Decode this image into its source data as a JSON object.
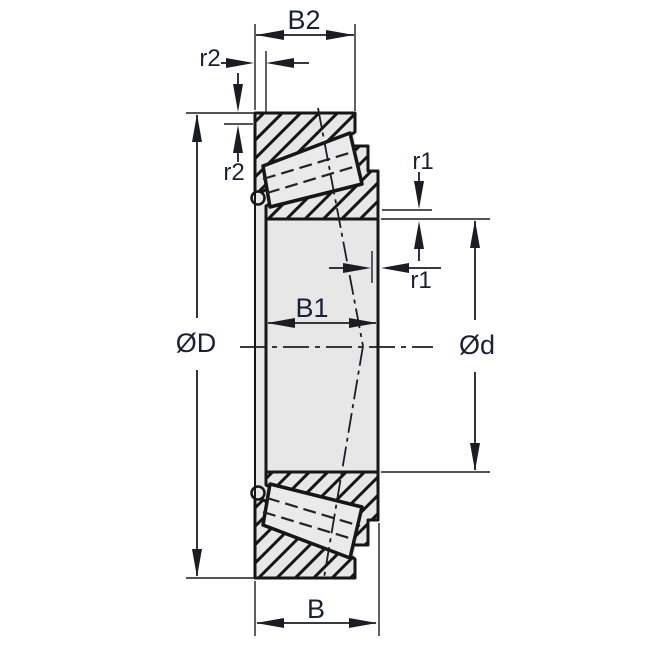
{
  "diagram": {
    "kind": "engineering-drawing",
    "subject": "tapered-roller-bearing-cross-section",
    "labels": {
      "b2": "B2",
      "b1": "B1",
      "b": "B",
      "outer_diameter": "ØD",
      "bore_diameter": "Ød",
      "r1": "r1",
      "r2": "r2"
    },
    "colors": {
      "line": "#161616",
      "dimension_line": "#1c1c24",
      "label_text": "#1b2134",
      "section_fill": "#e7e7e7",
      "roller_fill": "#eaeaea",
      "background": "#ffffff"
    }
  }
}
